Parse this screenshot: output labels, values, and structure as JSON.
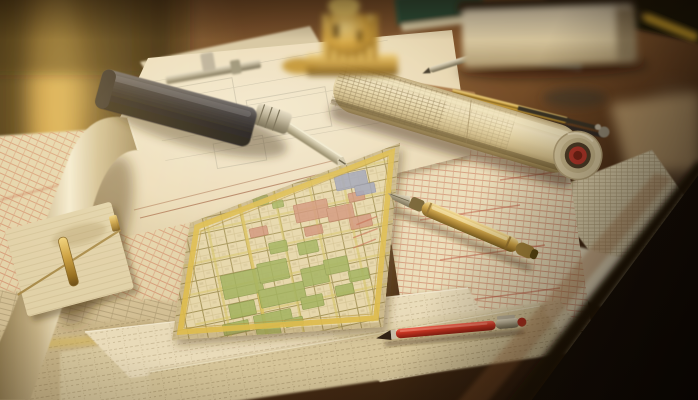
{
  "scene": {
    "title": "Architect's desk covered with city maps, blueprints and drafting tools in warm light",
    "setting": "photograph, shallow depth of field, golden-hour window light from the upper left",
    "objects": [
      {
        "id": "backdrop",
        "label": "Blurred warm background with golden window light"
      },
      {
        "id": "desk",
        "label": "Dark wooden desk surface"
      },
      {
        "id": "table-edge",
        "label": "Curved table edge falling into shadow"
      },
      {
        "id": "city-map",
        "label": "City street map with yellow border, green parks and pink blocks"
      },
      {
        "id": "blueprint-roll",
        "label": "Rolled-up plan with red-ringed end"
      },
      {
        "id": "blueprint-sheet",
        "label": "Large white plan sheet"
      },
      {
        "id": "pink-map-sheets",
        "label": "Faded pink street-plan sheets"
      },
      {
        "id": "scattered-sheets",
        "label": "Fanned-out drawing sheets"
      },
      {
        "id": "curled-sheet",
        "label": "Curled sheet catching the light"
      },
      {
        "id": "notepad-clip",
        "label": "Notepad with brass prong fastener"
      },
      {
        "id": "marking-gauge",
        "label": "Black-handled marking gauge with steel blade"
      },
      {
        "id": "caliper",
        "label": "Steel gauge bar"
      },
      {
        "id": "compass-divider",
        "label": "Drafting divider"
      },
      {
        "id": "gold-pencil",
        "label": "Striped drafting pencil"
      },
      {
        "id": "red-tip-pencil",
        "label": "Red-tipped pencil"
      },
      {
        "id": "silver-pencil",
        "label": "Steel pencil"
      },
      {
        "id": "fountain-pen",
        "label": "Brass fountain pen"
      },
      {
        "id": "red-pen",
        "label": "Red pen with steel clip"
      },
      {
        "id": "book-stack",
        "label": "Thick book lying on the desk"
      },
      {
        "id": "green-notebook",
        "label": "Green notebook"
      },
      {
        "id": "brass-ornament",
        "label": "Ornate brass instrument"
      },
      {
        "id": "yellow-pencil",
        "label": "Pencil at the table edge"
      }
    ],
    "palette": {
      "paper_cream": "#e8dcc0",
      "map_base": "#e6d9b0",
      "map_border_yellow": "#dcbc4c",
      "park_green": "#9cb25e",
      "block_pink": "#cf8d7a",
      "district_blue": "#97a0bf",
      "wood_lit": "#7c512c",
      "wood_dark": "#1d0e05",
      "backdrop_gold": "#caa24c",
      "red_accent": "#b23028",
      "brass": "#c89b3c",
      "steel": "#b9b29c",
      "black_tool": "#121218"
    }
  }
}
